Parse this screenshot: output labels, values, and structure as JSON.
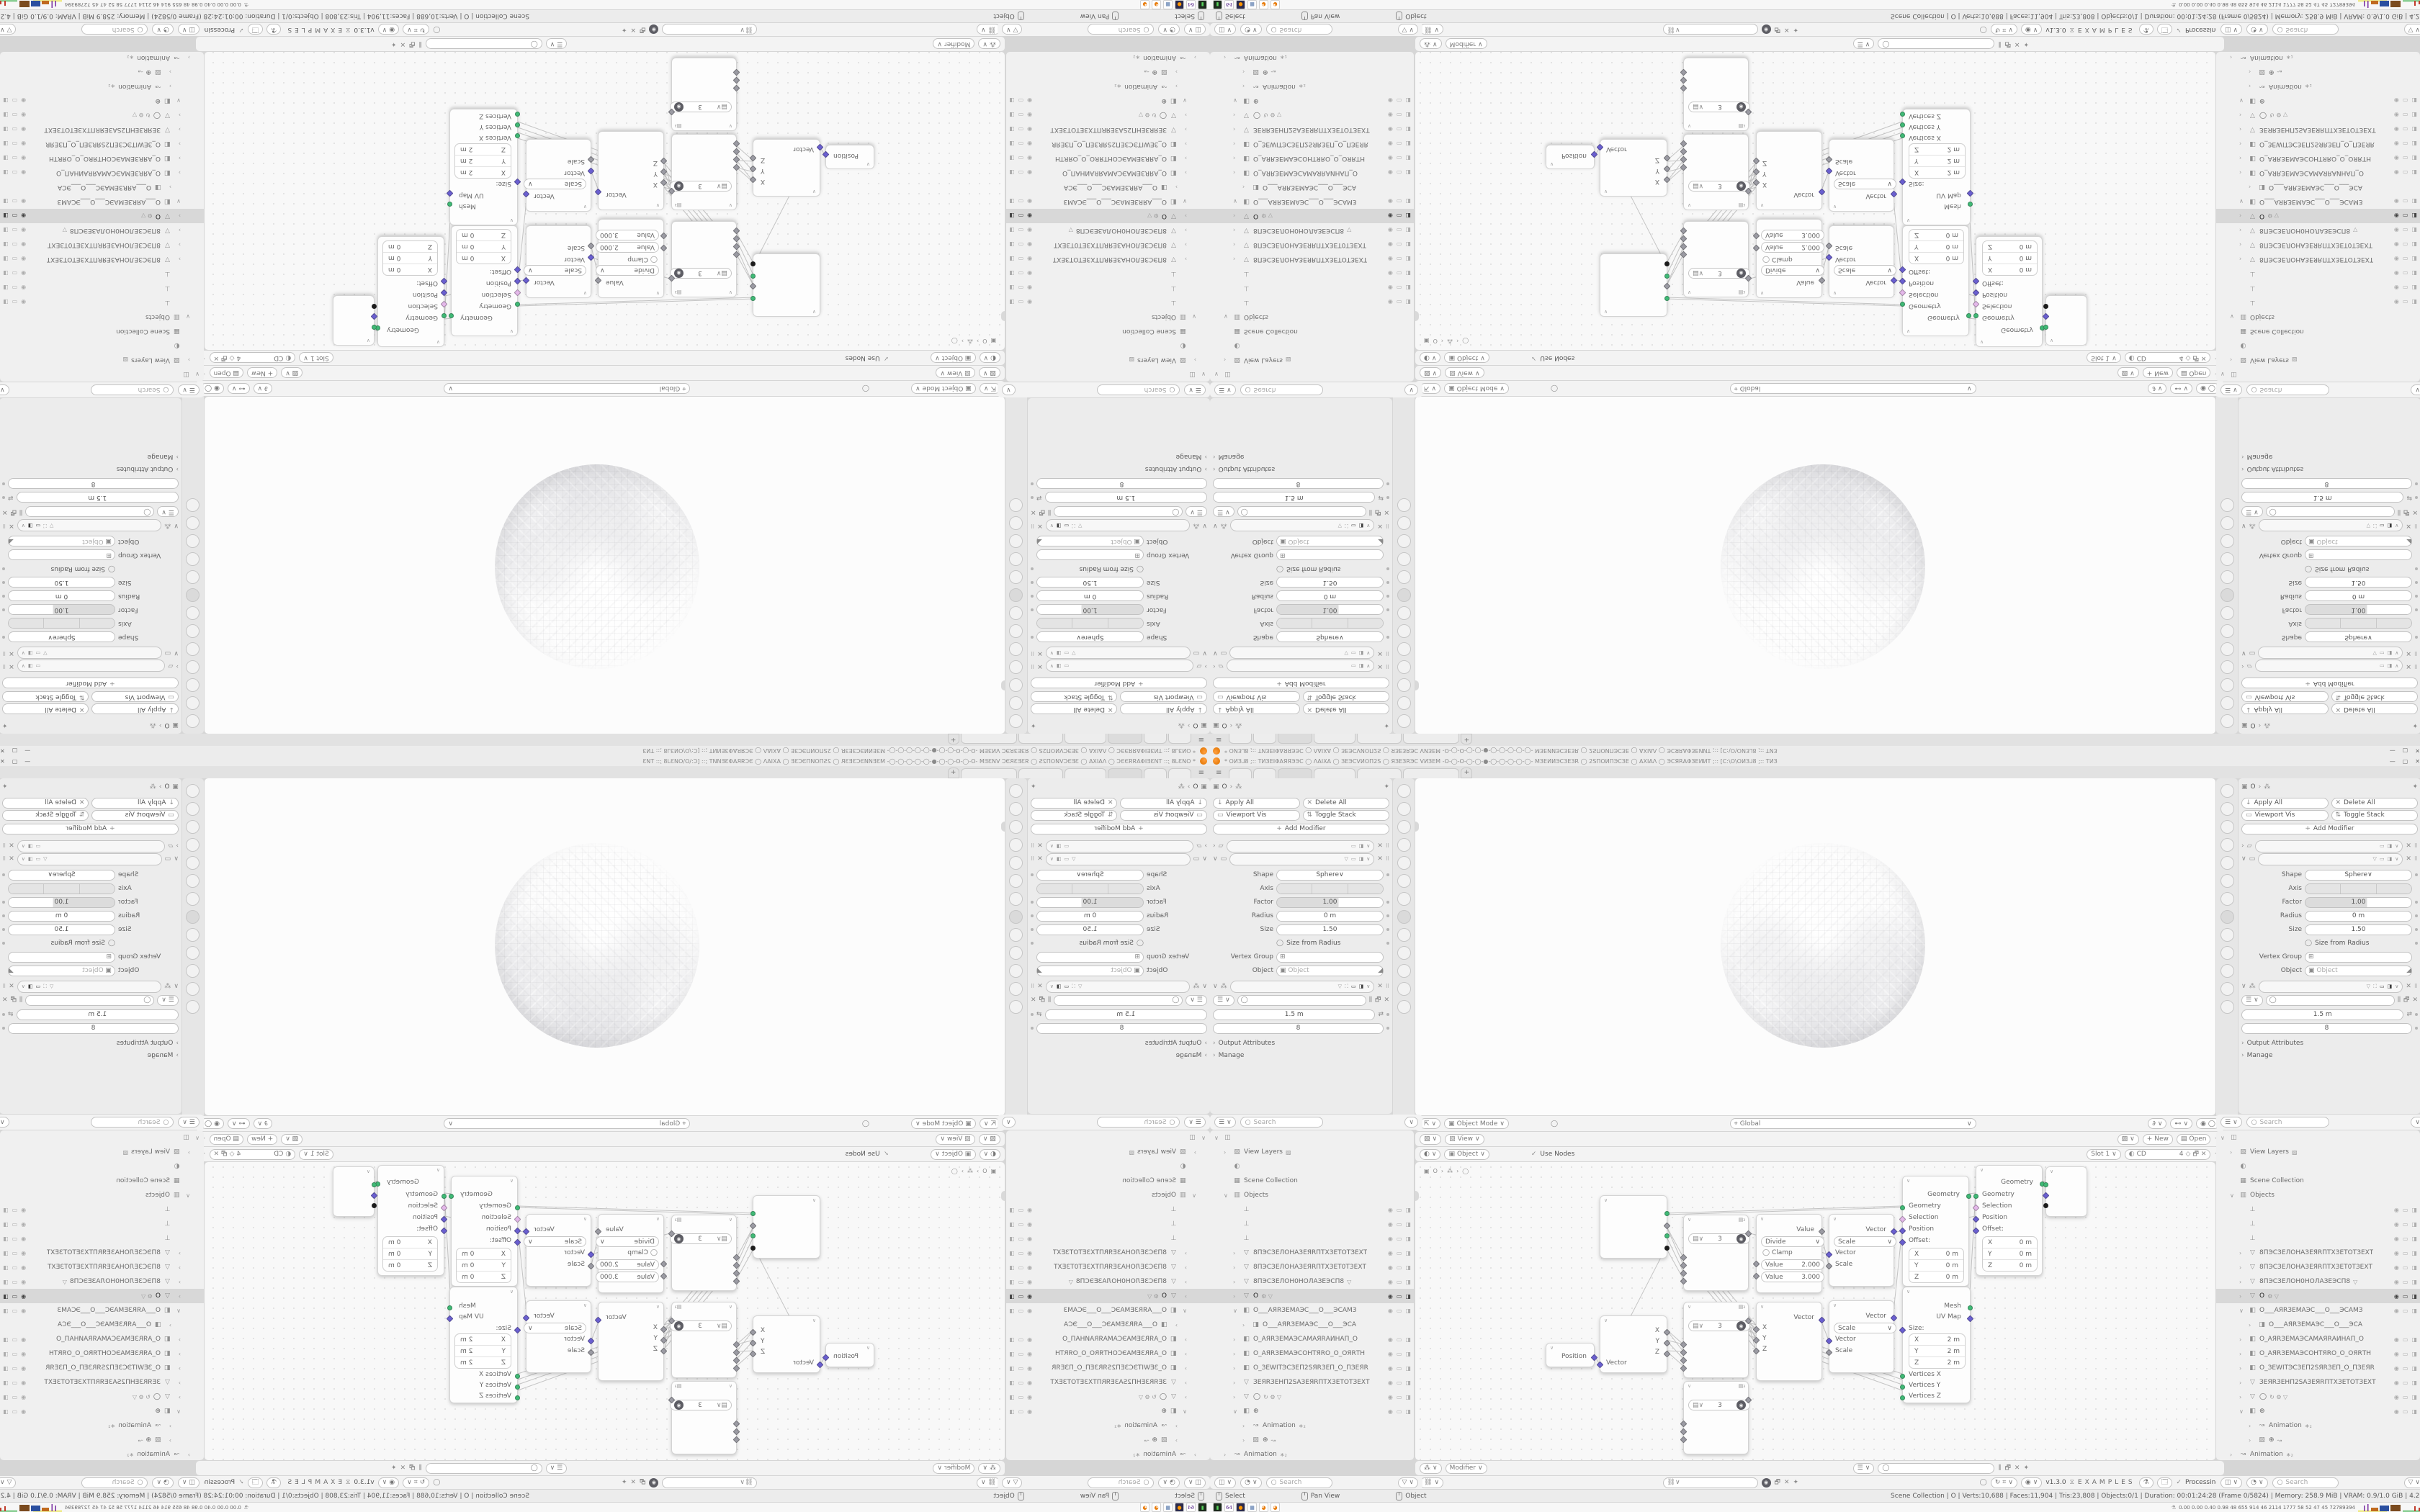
{
  "window": {
    "title": "* ОИЗ⅃8 ;:: ТИЗЕΙΦАЯЯЭЭС ◯ ΛАΙХА ◯ ЗЕЭСVИОП2S ◯ ЯЗЕЗRЭС VИЗЕМ -О-◯-О-◯-◯-●-◯-◯-◯-◯-◯- МЗЕИИЭСЗЕЗR ◯ 2SПОИПЭСЗЕ ◯ АХΙАΛ ◯ ЭСЯRАΦЗЕИИТ ;:: [С:\\О\\ОИЗ⅃8 ;:: ТИЗ",
    "min": "—",
    "max": "▢",
    "close": "✕"
  },
  "workspace_tabs": {
    "menu_icon": "≡",
    "tabs": [
      {
        "w": 30
      },
      {
        "w": 30
      },
      {
        "w": 46,
        "active": true
      },
      {
        "w": 56
      },
      {
        "w": 60
      },
      {
        "w": 76
      }
    ],
    "add_label": "+"
  },
  "props": {
    "breadcrumb": {
      "icon": "▣",
      "object": "O",
      "sep": "›",
      "sub": "⁂",
      "pin": "✦"
    },
    "apply_all": "Apply All",
    "delete_all": "Delete All",
    "viewport_vis": "Viewport Vis",
    "toggle_stack": "Toggle Stack",
    "add_modifier": "Add Modifier",
    "cast": {
      "shape_label": "Shape",
      "shape": "Sphere",
      "axis_label": "Axis",
      "axis": [
        "X",
        "Y",
        "Z"
      ],
      "factor_label": "Factor",
      "factor": "1.00",
      "radius_label": "Radius",
      "radius": "0 m",
      "size_label": "Size",
      "size": "1.50",
      "size_from_radius_label": "Size from Radius",
      "vertex_group_label": "Vertex Group",
      "object_label": "Object",
      "object_placeholder": "Object"
    },
    "geonodes": {
      "radius": "1.5 m",
      "count": "8",
      "output_attributes": "Output Attributes",
      "manage": "Manage"
    }
  },
  "outliner": {
    "search_placeholder": "Search",
    "rows": [
      {
        "chev": "∨",
        "icon": "◫",
        "label": "",
        "indent": 0
      },
      {
        "chev": "›",
        "icon": "▨",
        "label": "View Layers",
        "extra": "▨",
        "indent": 1
      },
      {
        "chev": "",
        "icon": "◐",
        "label": "",
        "indent": 1
      },
      {
        "chev": "",
        "icon": "▦",
        "label": "Scene Collection",
        "indent": 1
      },
      {
        "chev": "∨",
        "icon": "▥",
        "label": "Objects",
        "indent": 1
      },
      {
        "chev": "",
        "icon": "⊥",
        "label": "",
        "indent": 2,
        "vis": true
      },
      {
        "chev": "",
        "icon": "⊥",
        "label": "",
        "indent": 2,
        "vis": true
      },
      {
        "chev": "",
        "icon": "⊥",
        "label": "",
        "indent": 2,
        "vis": true
      },
      {
        "chev": "›",
        "icon": "▽",
        "label": "8ПЭСЗЕЛОНАЗЕЯRПТХЗЕТОТЗЕХТ",
        "indent": 2,
        "vis": true
      },
      {
        "chev": "›",
        "icon": "▽",
        "label": "8ПЭСЗЕЛОНАЗЕЯRПТХЗЕТ0ТЗЕХТ",
        "indent": 2,
        "vis": true
      },
      {
        "chev": "›",
        "icon": "▽",
        "label": "8ПЭСЗЕЛОН0НОЛАЗЕЭСП8",
        "extra": "▽",
        "indent": 2,
        "vis": true
      },
      {
        "chev": "›",
        "icon": "▽",
        "label": "O",
        "extra": "⚙ ▽",
        "indent": 2,
        "vis": true,
        "active": true
      },
      {
        "chev": "∨",
        "icon": "◧",
        "label": "O___АЯRЗЕМАЭС___О___ЭСАМЗ",
        "indent": 2,
        "vis": true
      },
      {
        "chev": "›",
        "icon": "◨",
        "label": "O___АЯRЗЕМАЭС___О___ЭСА",
        "indent": 3
      },
      {
        "chev": "›",
        "icon": "◧",
        "label": "O_АЯRЗЕМАЭСАМАЯRАИНАП_О",
        "indent": 2,
        "vis": true
      },
      {
        "chev": "›",
        "icon": "◧",
        "label": "O_АЯRЗЕМАЭСОНТЯRО_О_ОЯRТН",
        "indent": 2,
        "vis": true
      },
      {
        "chev": "›",
        "icon": "◧",
        "label": "O_ЗЕWІТЭСЗЕП2SЯRЗЕП_О_ПЗЕЯR",
        "indent": 2,
        "vis": true
      },
      {
        "chev": "›",
        "icon": "▽",
        "label": "ЗЕЯRЗЕНП2SАЗЕЯRПТХЗЕТОТЗЕХТ",
        "indent": 2,
        "vis": true
      },
      {
        "chev": "›",
        "icon": "▽",
        "label": "◯",
        "extra": "↻ ⚙ ▽",
        "indent": 2,
        "vis": true
      },
      {
        "chev": "∨",
        "icon": "◧",
        "label": "⊕",
        "indent": 2,
        "vis": true
      },
      {
        "chev": "›",
        "icon": "↝",
        "label": "Animation",
        "extra": "∗₂",
        "indent": 3
      },
      {
        "chev": "›",
        "icon": "▨",
        "label": "⊕",
        "extra": "↝",
        "indent": 3
      },
      {
        "chev": "›",
        "icon": "↝",
        "label": "Animation",
        "extra": "∗₂",
        "indent": 1
      }
    ]
  },
  "viewport_header": {
    "mode": "Object Mode",
    "menus": [
      "View",
      "Select",
      "Add",
      "Object"
    ],
    "orientation": "Global"
  },
  "image_header": {
    "editor": "View",
    "menus": [
      "View",
      "Image"
    ],
    "new_label": "New",
    "open_label": "Open"
  },
  "tex_header": {
    "target": "Object",
    "menus": [
      "View",
      "Select",
      "Add",
      "Node"
    ],
    "use_nodes": "Use Nodes",
    "slot": "Slot 1",
    "image_name": "CD",
    "count": "4"
  },
  "geo_header": {
    "mode": "Modifier",
    "menus": [
      "View",
      "Select",
      "Add",
      "Node"
    ]
  },
  "examples_header": {
    "menus": [
      "View",
      "Select",
      "Add",
      "Node"
    ],
    "version": "v1.3.0",
    "title": "EXAMPLES",
    "status": "Processing"
  },
  "node_editor": {
    "breadcrumb": {
      "icon": "▣",
      "object": "O",
      "sep": "›",
      "sub": "⁂",
      "leaf": "◯"
    },
    "nodes": {
      "int3": {
        "value": "3"
      },
      "math": {
        "out_label": "Value",
        "operation": "Divide",
        "clamp_label": "Clamp",
        "value1_label": "Value",
        "value1": "2.000",
        "value2_label": "Value",
        "value2": "3.000"
      },
      "vecscale": {
        "out_label": "Vector",
        "operation": "Scale",
        "in_vector": "Vector",
        "in_scale": "Scale"
      },
      "setpos": {
        "out_label": "Geometry",
        "in_geometry": "Geometry",
        "in_selection": "Selection",
        "in_position": "Position",
        "in_offset": "Offset:",
        "axes": [
          "X",
          "Y",
          "Z"
        ],
        "value": "0 m"
      },
      "cube": {
        "out_mesh": "Mesh",
        "out_uv": "UV Map",
        "size_label": "Size:",
        "axes": [
          "X",
          "Y",
          "Z"
        ],
        "value": "2 m",
        "ins": [
          "Vertices X",
          "Vertices Y",
          "Vertices Z"
        ]
      },
      "position": {
        "out_label": "Position"
      },
      "separate": {
        "in_label": "Vector",
        "outs": [
          "X",
          "Y",
          "Z"
        ]
      },
      "combine": {
        "ins": [
          "X",
          "Y",
          "Z"
        ],
        "out_label": "Vector"
      }
    }
  },
  "status_bar": {
    "hints": [
      {
        "label": "Select"
      },
      {
        "label": "Pan View"
      },
      {
        "label": "Object"
      }
    ],
    "stats": "Scene Collection | O | Verts:10,688 | Faces:11,904 | Tris:23,808 | Objects:0/1 | Duration: 00:01:24:28 (Frame 0/5824) | Memory: 258.9 MiB | VRAM: 0.9/1.0 GiB | 4.2.3"
  },
  "taskbar": {
    "icons": [
      {
        "glyph": "▮",
        "bg": "#1d2b1d",
        "fg": "#58d25c",
        "name": "terminal"
      },
      {
        "glyph": "64",
        "bg": "#ffffff",
        "fg": "#5b2d8e",
        "name": "installer-64"
      },
      {
        "glyph": "●",
        "bg": "#2b2b4d",
        "fg": "#ff9500",
        "name": "firefox"
      },
      {
        "glyph": "▦",
        "bg": "#ffffff",
        "fg": "#4a6fa5",
        "name": "calculator"
      },
      {
        "glyph": "◕",
        "bg": "#ffffff",
        "fg": "#e87d0d",
        "name": "blender"
      },
      {
        "glyph": "◕",
        "bg": "#ffffff",
        "fg": "#e87d0d",
        "name": "blender"
      }
    ],
    "tray_text": "0.00 0.00 0.40 0.98   48   655   914   46   2114 1777   58   52   47   45   72789394"
  },
  "strip_icons": [
    {
      "g": "⇅"
    },
    {
      "g": "▤"
    },
    {
      "g": "▦"
    },
    {
      "g": "▨"
    },
    {
      "g": "✦"
    },
    {
      "g": "◐"
    },
    {
      "g": "▣"
    },
    {
      "g": "⚙",
      "active": true
    },
    {
      "g": "↝"
    },
    {
      "g": "◉"
    },
    {
      "g": "◎"
    },
    {
      "g": "▽"
    },
    {
      "g": "◑"
    }
  ]
}
